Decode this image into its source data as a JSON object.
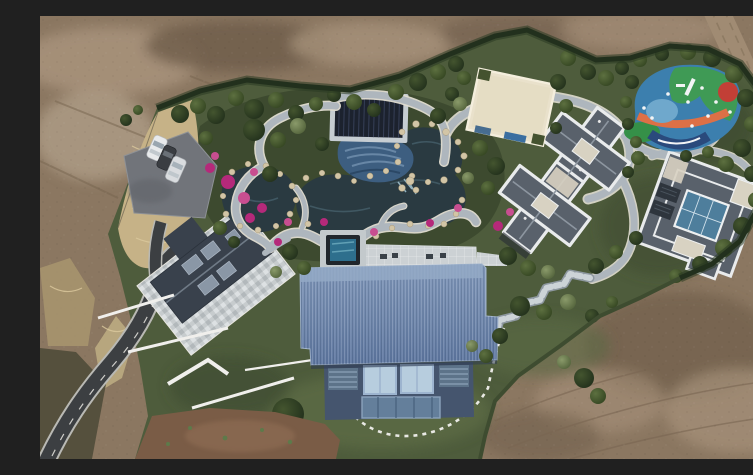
{
  "meta": {
    "title": "Aerial drone photograph of a landscaped private estate surrounded by bare excavated earth",
    "image_type": "aerial-photograph",
    "width_px": 753,
    "height_px": 443
  },
  "scene": {
    "description": "Top-down drone view of a luxury estate: a large blue metal-roofed villa, a slate-roofed villa with stone courtyard, two gray-roofed courtyard villas, a cream flat-roofed pavilion, a dark garden pavilion, an ornamental garden with dark ponds, rock edges, magenta azaleas and winding stone paths, a colorful children's playground, a parking pad with three cars, an asphalt driveway, lawns with trees, all enclosed by a dark hedge and surrounded by brown bare dirt with a dirt track at top right.",
    "objects": [
      {
        "name": "bare-earth-surroundings",
        "desc": "brown excavated soil around the estate"
      },
      {
        "name": "dirt-track",
        "desc": "dirt road curving along the top-right corner"
      },
      {
        "name": "boundary-hedge",
        "desc": "dark green hedge enclosing the property"
      },
      {
        "name": "parking-pad",
        "desc": "gray parking area, three parked cars (two white, one dark)"
      },
      {
        "name": "asphalt-driveway",
        "desc": "dark S-curved driveway from bottom-left corner"
      },
      {
        "name": "courtyard-villa-west",
        "desc": "slate gable roof villa with mosaic stone courtyard and white garden walls"
      },
      {
        "name": "ornamental-garden",
        "desc": "ponds, beige rocks, magenta flower beds, winding gray paths"
      },
      {
        "name": "garden-pavilion",
        "desc": "dark striped-roof pavilion with blue mosaic patio"
      },
      {
        "name": "plunge-pool",
        "desc": "small dark square pool beside the main villa terrace"
      },
      {
        "name": "main-villa-blue-roof",
        "desc": "large corrugated blue metal roof, glazed facade, curved stepping-stone path"
      },
      {
        "name": "cross-plan-villa",
        "desc": "two cross-shaped gray hip roofs with white parapets"
      },
      {
        "name": "courtyard-villa-east",
        "desc": "square villa with central blue glass atrium and white parapets"
      },
      {
        "name": "cream-pavilion",
        "desc": "cream flat-roofed building near the north hedge"
      },
      {
        "name": "playground",
        "desc": "colorful play surface with blue, green, orange and red swirls and white equipment"
      },
      {
        "name": "zigzag-walkway",
        "desc": "stepped stone walkway linking the villas"
      },
      {
        "name": "lawn",
        "desc": "green lawn with large dark trees"
      },
      {
        "name": "red-soil-patch",
        "desc": "reddish disturbed soil at bottom centre"
      }
    ],
    "counts": {
      "cars": 3,
      "buildings": 6,
      "ponds": 3
    }
  },
  "palette": {
    "dirt-base": "#8b7761",
    "dirt-light": "#a6917a",
    "dirt-dark": "#6e5c4a",
    "dirt-red": "#7a5c46",
    "dirt-road": "#a08b73",
    "scrub-dark": "#55503d",
    "lawn": "#4e5c3c",
    "lawn-light": "#5c6b45",
    "garden-green": "#3d4a2f",
    "hedge": "#22301d",
    "tan-grass": "#c6b287",
    "tan-light": "#dcca9e",
    "asphalt": "#3c3f42",
    "curb": "#e8e6e0",
    "parking": "#71747a",
    "path-gray": "#aeb6bd",
    "path-edge": "#e2ded2",
    "walk-stone": "#8e98a0",
    "pond": "#2a3a41",
    "pond-light": "#46606b",
    "mosaic-blue": "#3d5e80",
    "mosaic-wave": "#6d8cab",
    "rock": "#d2c5a6",
    "flower": "#b5297a",
    "flower-light": "#c84e90",
    "pavilion": "#1c222e",
    "pavilion-edge": "#c6cdd2",
    "courtyard": "#c7ccce",
    "slate-roof": "#39414c",
    "slate-ridge": "#6f7a86",
    "wall-white": "#f0efec",
    "roof-blue-hi": "#8097ba",
    "roof-blue-lo": "#5d76a0",
    "ridge-blue": "#93a9c6",
    "facade-blue": "#45556e",
    "window-glass": "#b7cdde",
    "window-frame": "#9db4cf",
    "louver": "#5d7389",
    "door-glass": "#647f9b",
    "roof-gray": "#59616b",
    "parapet": "#e9ebec",
    "flat-beige": "#d8d2c2",
    "skylight": "#4e7e9c",
    "solar-dark": "#2e353d",
    "cream": "#e9e1cb",
    "pg-blue": "#3c7fae",
    "pg-green": "#3f9a55",
    "pg-green2": "#359048",
    "pg-orange": "#dd7046",
    "pg-red": "#c23f36",
    "pg-navy": "#2a4a7c",
    "pg-lightblue": "#6fa8cc",
    "car-white": "#e8eaec",
    "car-dark": "#3a3d42",
    "car-silver": "#d9dcdf",
    "pool-dark": "#20262c",
    "pool-water": "#2e6f8d",
    "terrace": "#ccd1d4"
  }
}
